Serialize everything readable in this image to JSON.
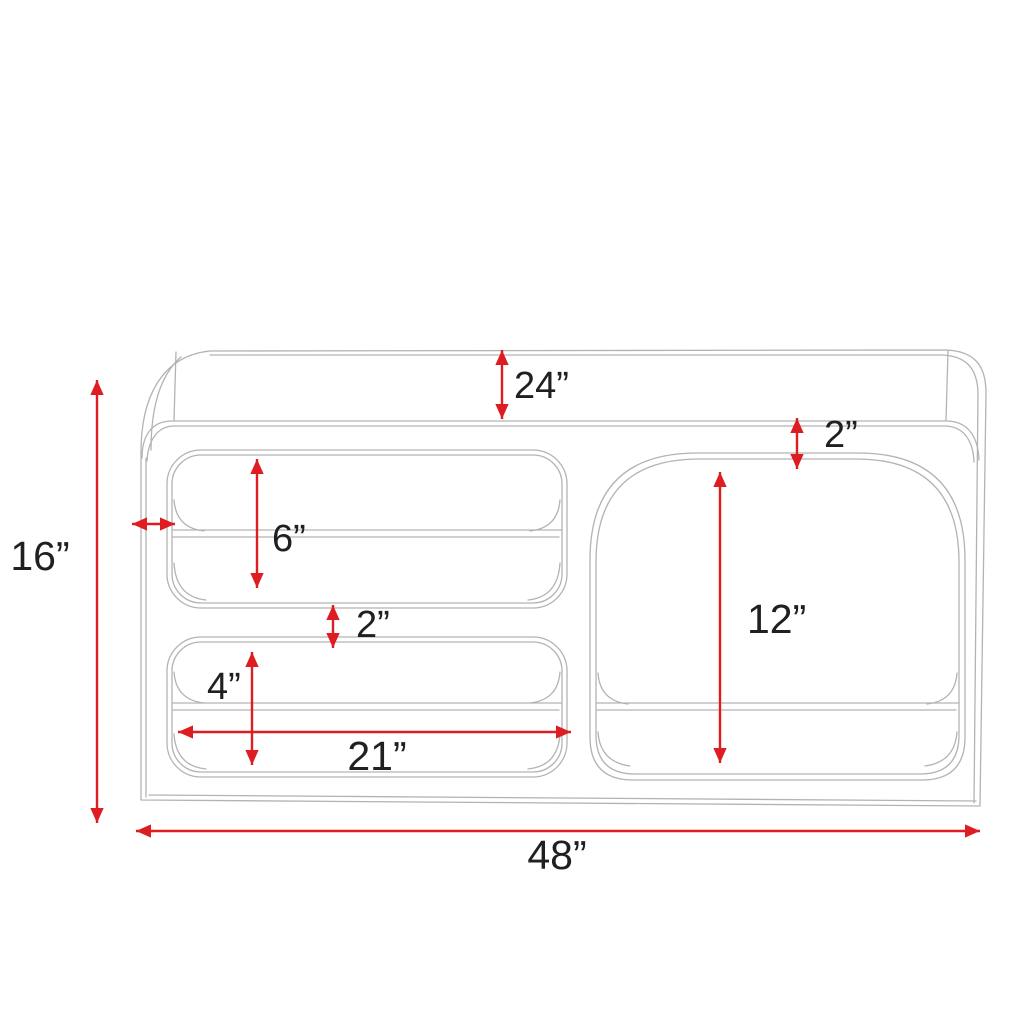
{
  "diagram": {
    "colors": {
      "arrow": "#dd1d21",
      "linework": "#b3b3b3",
      "label": "#202020",
      "background": "#ffffff"
    },
    "dimensions": {
      "top_depth": {
        "text": "24”",
        "inches": 24
      },
      "top_right_gap": {
        "text": "2”",
        "inches": 2
      },
      "overall_height": {
        "text": "16”",
        "inches": 16
      },
      "upper_cubby_height": {
        "text": "6”",
        "inches": 6
      },
      "cubby_gap": {
        "text": "2”",
        "inches": 2
      },
      "lower_cubby_height": {
        "text": "4”",
        "inches": 4
      },
      "cubby_width": {
        "text": "21”",
        "inches": 21
      },
      "right_cubby_height": {
        "text": "12”",
        "inches": 12
      },
      "overall_width": {
        "text": "48”",
        "inches": 48
      }
    }
  }
}
